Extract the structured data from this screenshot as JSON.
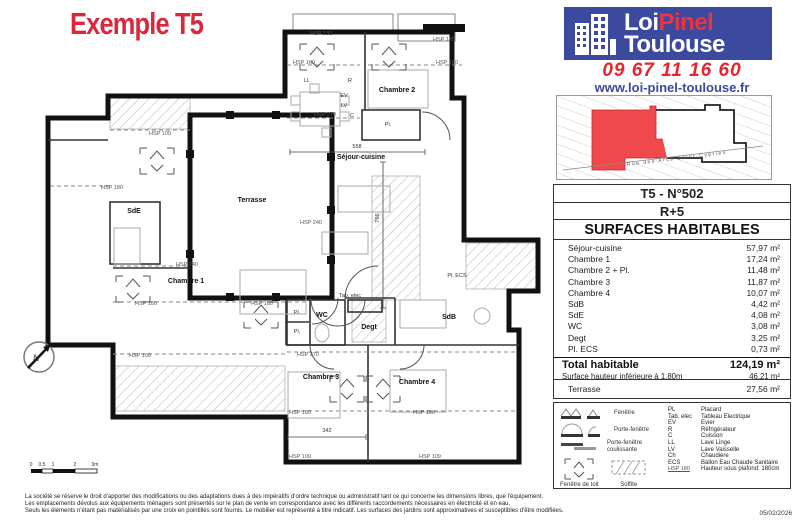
{
  "title": "Exemple T5",
  "branding": {
    "logo_word1": "Loi",
    "logo_word2": "Pinel",
    "logo_word3": "Toulouse",
    "phone": "09 67 11 16 60",
    "website": "www.loi-pinel-toulouse.fr"
  },
  "site_plan": {
    "street": "Rue des Arcs-Saint-Cyprien"
  },
  "unit": {
    "ref": "T5 - N°502",
    "floor": "R+5"
  },
  "surfaces": {
    "header": "SURFACES HABITABLES",
    "rows": [
      {
        "label": "Séjour-cuisine",
        "value": "57,97 m²"
      },
      {
        "label": "Chambre 1",
        "value": "17,24 m²"
      },
      {
        "label": "Chambre 2 + Pl.",
        "value": "11,48 m²"
      },
      {
        "label": "Chambre 3",
        "value": "11,87 m²"
      },
      {
        "label": "Chambre 4",
        "value": "10,07 m²"
      },
      {
        "label": "SdB",
        "value": "4,42 m²"
      },
      {
        "label": "SdE",
        "value": "4,08 m²"
      },
      {
        "label": "WC",
        "value": "3,08 m²"
      },
      {
        "label": "Degt",
        "value": "3,25 m²"
      },
      {
        "label": "Pl. ECS",
        "value": "0,73 m²"
      }
    ],
    "total_label": "Total habitable",
    "total_value": "124,19 m²",
    "sub_label": "Surface hauteur inférieure à 1,80m",
    "sub_value": "46,21 m²",
    "terrace_label": "Terrasse",
    "terrace_value": "27,56 m²"
  },
  "legend": {
    "symbol_labels": [
      "Fenêtre",
      "Porte-fenêtre",
      "Porte-fenêtre coulissante",
      "Fenêtre de toit",
      "Soffite"
    ],
    "abbreviations": [
      {
        "abbr": "PL",
        "meaning": "Placard"
      },
      {
        "abbr": "Tab. elec",
        "meaning": "Tableau Electrique"
      },
      {
        "abbr": "EV",
        "meaning": "Evier"
      },
      {
        "abbr": "R",
        "meaning": "Réfrigérateur"
      },
      {
        "abbr": "C",
        "meaning": "Cuisson"
      },
      {
        "abbr": "LL",
        "meaning": "Lave Linge"
      },
      {
        "abbr": "LV",
        "meaning": "Lave Vaisselle"
      },
      {
        "abbr": "Ch",
        "meaning": "Chaudière"
      },
      {
        "abbr": "ECS",
        "meaning": "Ballon Eau Chaude Sanitaire"
      },
      {
        "abbr": "HSP 180",
        "meaning": "Hauteur sous plafond: 180cm"
      }
    ]
  },
  "date": "05/02/2026",
  "footer_lines": [
    "La société se réserve le droit  d'apporter des modifications ou des adaptations dues à des impératifs d'ordre technique ou administratif tant ce qui concerne les dimensions libres, que l'équipement.",
    "Les emplacements dévolus aux équipements ménagers sont présentés sur le plan de vente en correspondance avec les différents raccordements nécessaires en électricité et en eau.",
    "Seuls les éléments n'étant pas matérialisés par une croix en pointillés sont fournis. Le mobilier est représenté à titre indicatif. Les surfaces des jardins sont approximatives et susceptibles d'être modifiées."
  ],
  "plan": {
    "compass_label": "N",
    "rooms": [
      {
        "name": "Terrasse",
        "x": 252,
        "y": 202
      },
      {
        "name": "Séjour-cuisine",
        "x": 361,
        "y": 159
      },
      {
        "name": "Chambre 1",
        "x": 186,
        "y": 283
      },
      {
        "name": "Chambre 2",
        "x": 397,
        "y": 92
      },
      {
        "name": "Chambre 3",
        "x": 321,
        "y": 379
      },
      {
        "name": "Chambre 4",
        "x": 417,
        "y": 384
      },
      {
        "name": "SdE",
        "x": 134,
        "y": 213
      },
      {
        "name": "SdB",
        "x": 449,
        "y": 319
      },
      {
        "name": "WC",
        "x": 322,
        "y": 317
      },
      {
        "name": "Degt",
        "x": 369,
        "y": 329
      }
    ],
    "fixtures": [
      {
        "text": "Pl.",
        "x": 388,
        "y": 126
      },
      {
        "text": "Pl.",
        "x": 297,
        "y": 314
      },
      {
        "text": "Pl.",
        "x": 297,
        "y": 333
      },
      {
        "text": "Pl. ECS",
        "x": 457,
        "y": 277
      },
      {
        "text": "Tab. elec",
        "x": 350,
        "y": 297
      },
      {
        "text": "LL",
        "x": 307,
        "y": 82
      },
      {
        "text": "R",
        "x": 350,
        "y": 82
      },
      {
        "text": "EV",
        "x": 344,
        "y": 97
      },
      {
        "text": "LV",
        "x": 344,
        "y": 107
      },
      {
        "text": "C",
        "x": 352,
        "y": 117
      }
    ],
    "hsp_labels": [
      {
        "text": "HSP 132",
        "x": 321,
        "y": 35
      },
      {
        "text": "HSP 145",
        "x": 444,
        "y": 41
      },
      {
        "text": "HSP 160",
        "x": 304,
        "y": 64
      },
      {
        "text": "HSP 160",
        "x": 447,
        "y": 64
      },
      {
        "text": "HSP 270",
        "x": 325,
        "y": 116
      },
      {
        "text": "HSP 270",
        "x": 308,
        "y": 356
      },
      {
        "text": "HSP 100",
        "x": 160,
        "y": 135
      },
      {
        "text": "HSP 100",
        "x": 140,
        "y": 357
      },
      {
        "text": "HSP 180",
        "x": 112,
        "y": 189
      },
      {
        "text": "HSP 180",
        "x": 146,
        "y": 305
      },
      {
        "text": "HSP 180",
        "x": 262,
        "y": 305
      },
      {
        "text": "HSP 180",
        "x": 300,
        "y": 414
      },
      {
        "text": "HSP 180",
        "x": 424,
        "y": 414
      },
      {
        "text": "HSP 240",
        "x": 311,
        "y": 224
      },
      {
        "text": "HSP 240",
        "x": 187,
        "y": 266
      },
      {
        "text": "HSP 109",
        "x": 300,
        "y": 458
      },
      {
        "text": "HSP 109",
        "x": 430,
        "y": 458
      }
    ],
    "dimensions": [
      {
        "text": "558",
        "x": 357,
        "y": 148,
        "rot": false
      },
      {
        "text": "766",
        "x": 379,
        "y": 218,
        "rot": true
      },
      {
        "text": "342",
        "x": 327,
        "y": 432,
        "rot": false
      }
    ],
    "scale_labels": [
      "0",
      "0,5",
      "1",
      "2",
      "3m"
    ]
  }
}
